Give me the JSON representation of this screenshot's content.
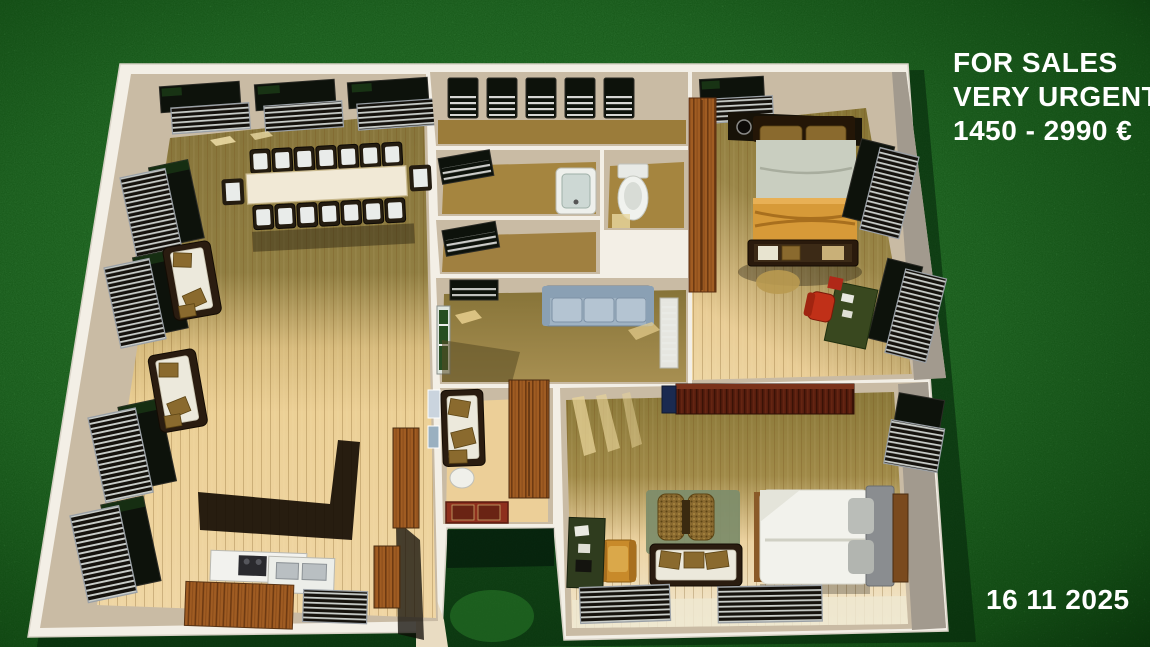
{
  "listing": {
    "line1": "FOR SALES",
    "line2": "VERY URGENTE",
    "price": "1450 - 2990 €",
    "date": "16 11 2025"
  },
  "colors": {
    "grass_light": "#2f7e30",
    "grass_mid": "#1e5c20",
    "grass_dark": "#0c330e",
    "wall_white": "#f3efe6",
    "wall_tan": "#c9bba4",
    "wall_gray": "#a29a8e",
    "floor_pale": "#eed29c",
    "floor_olive": "#8d7b3e",
    "floor_brown": "#a5853f",
    "window_dark": "#0d120b",
    "radiator_dark": "#15120d",
    "radiator_steel": "#c9cdc9",
    "wood_wardrobe": "#a05c22",
    "wardrobe_maroon": "#571d0e",
    "sofa_gray": "#9fb2c2",
    "bed_blanket_orange": "#d79a38",
    "rug_red": "#8e2f1d",
    "rug_green": "#7e8d6a",
    "armchair_orange": "#c88a2a",
    "desk_green": "#2f3c1e",
    "chair_red": "#c03018",
    "text_white": "#ffffff"
  },
  "scene": {
    "type": "3d-floor-plan-render",
    "rooms": [
      {
        "name": "living-dining-room",
        "furniture": [
          "dining-table",
          "dining-chairs",
          "wall-sofa",
          "wall-sofa",
          "window-radiators",
          "kitchen-counter",
          "kitchen-sink",
          "kitchen-island",
          "tall-cabinet"
        ]
      },
      {
        "name": "corridor",
        "furniture": [
          "five-windows"
        ]
      },
      {
        "name": "bathroom",
        "furniture": [
          "bathtub",
          "window"
        ]
      },
      {
        "name": "wc",
        "furniture": [
          "toilet"
        ]
      },
      {
        "name": "storage-room",
        "furniture": [
          "window"
        ]
      },
      {
        "name": "middle-living-room",
        "furniture": [
          "gray-sofa",
          "window",
          "louver-door"
        ]
      },
      {
        "name": "hallway",
        "furniture": [
          "loveseat",
          "ottoman",
          "red-rug",
          "wardrobe",
          "wall-pictures"
        ]
      },
      {
        "name": "bedroom-top-right",
        "furniture": [
          "double-bed",
          "orange-blanket",
          "wardrobe",
          "foot-bench",
          "wall-lamps",
          "desk",
          "red-office-chair",
          "window-radiators"
        ]
      },
      {
        "name": "bedroom-bottom-right",
        "furniture": [
          "double-bed",
          "long-wardrobe",
          "white-sofa",
          "wicker-chair",
          "green-rug",
          "orange-armchair",
          "desk",
          "radiators"
        ]
      },
      {
        "name": "courtyard",
        "furniture": []
      }
    ]
  }
}
